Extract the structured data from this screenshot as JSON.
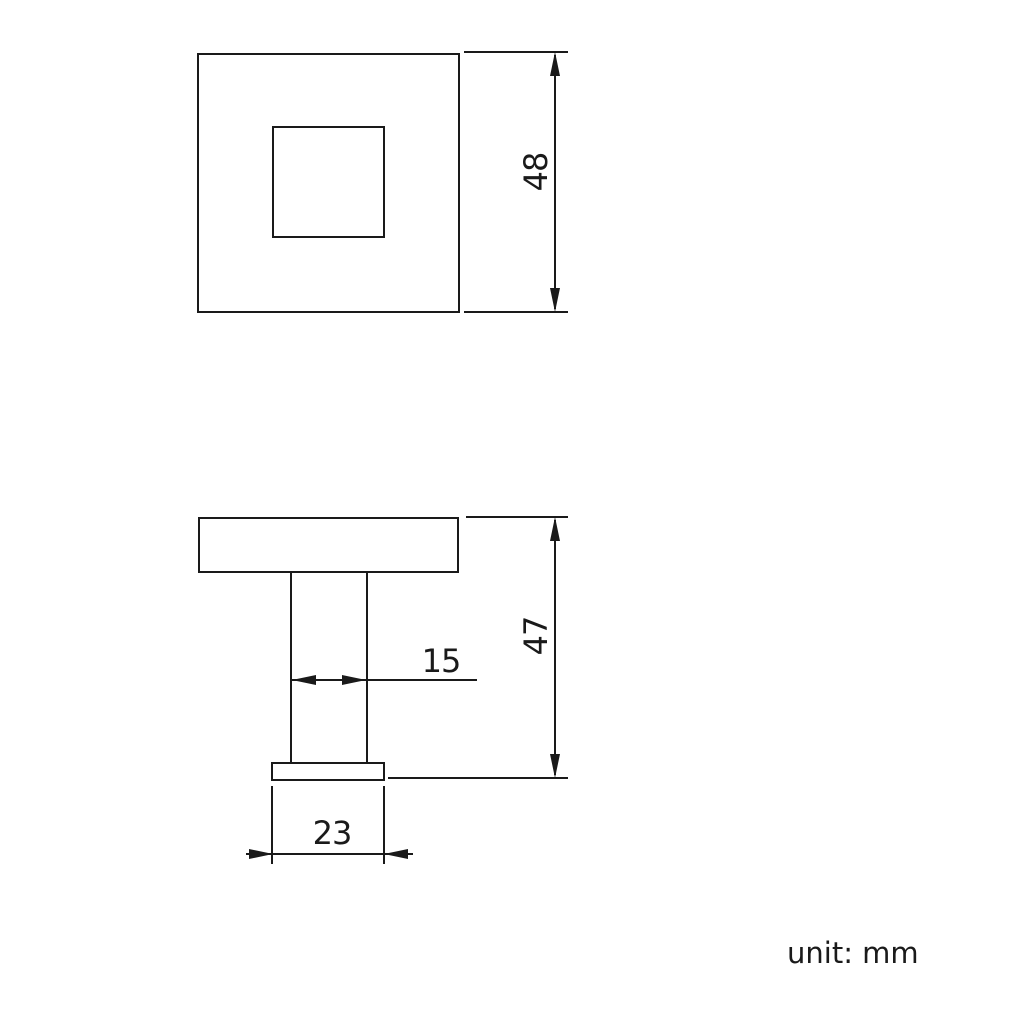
{
  "colors": {
    "line": "#1a1a1a",
    "background": "#ffffff"
  },
  "front_view": {
    "dim_height": "48"
  },
  "side_view": {
    "dim_stem_width": "15",
    "dim_overall_height": "47",
    "dim_base_width": "23"
  },
  "footer": {
    "unit_note": "unit: mm"
  }
}
